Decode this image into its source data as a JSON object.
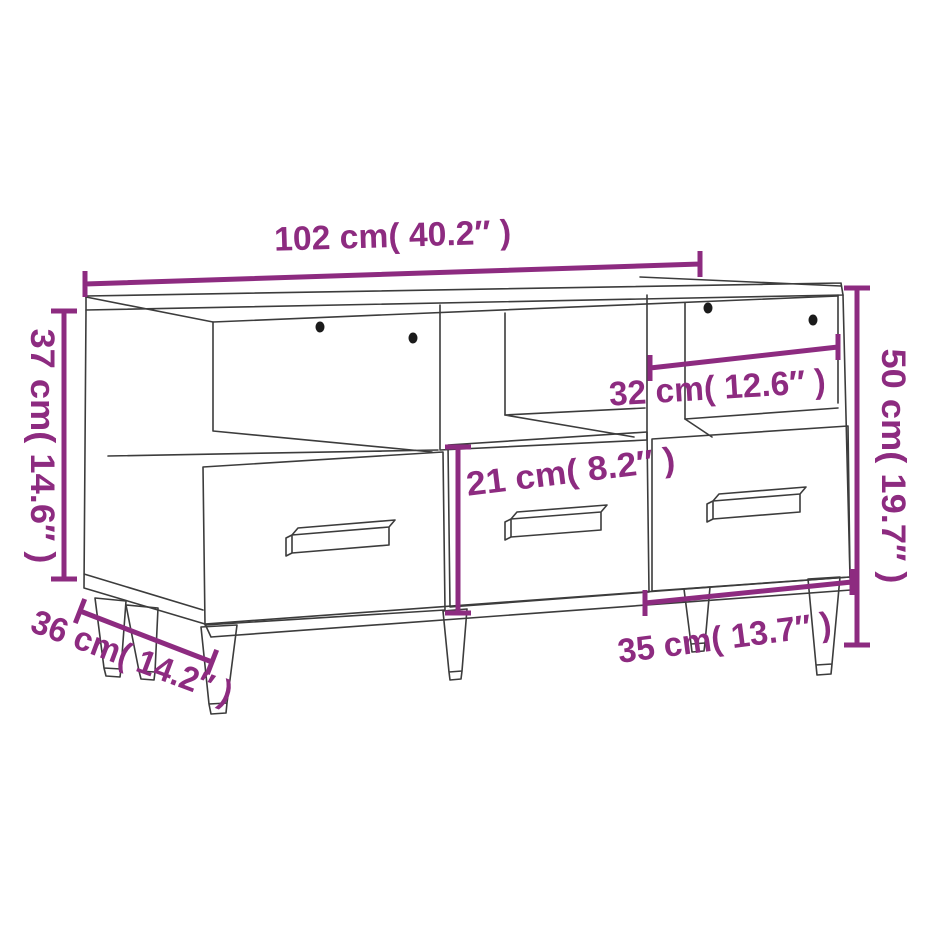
{
  "diagram": {
    "subject": "tv-stand-sketch",
    "style": "product-dimension-diagram"
  },
  "colors": {
    "background": "#ffffff",
    "sketch_line": "#3c3c3c",
    "dimension_accent": "#8d2b80",
    "screw_dot": "#1b1b1b"
  },
  "icons": {
    "screw_hole": "black-dot"
  },
  "dimensions": {
    "top_width": "102 cm( 40.2″ )",
    "left_height": "37 cm( 14.6″ )",
    "overall_height": "50 cm( 19.7″ )",
    "compartment_width": "32 cm( 12.6″ )",
    "drawer_height": "21 cm( 8.2″ )",
    "drawer_width": "35 cm( 13.7″ )",
    "depth": "36 cm( 14.2″ )"
  }
}
